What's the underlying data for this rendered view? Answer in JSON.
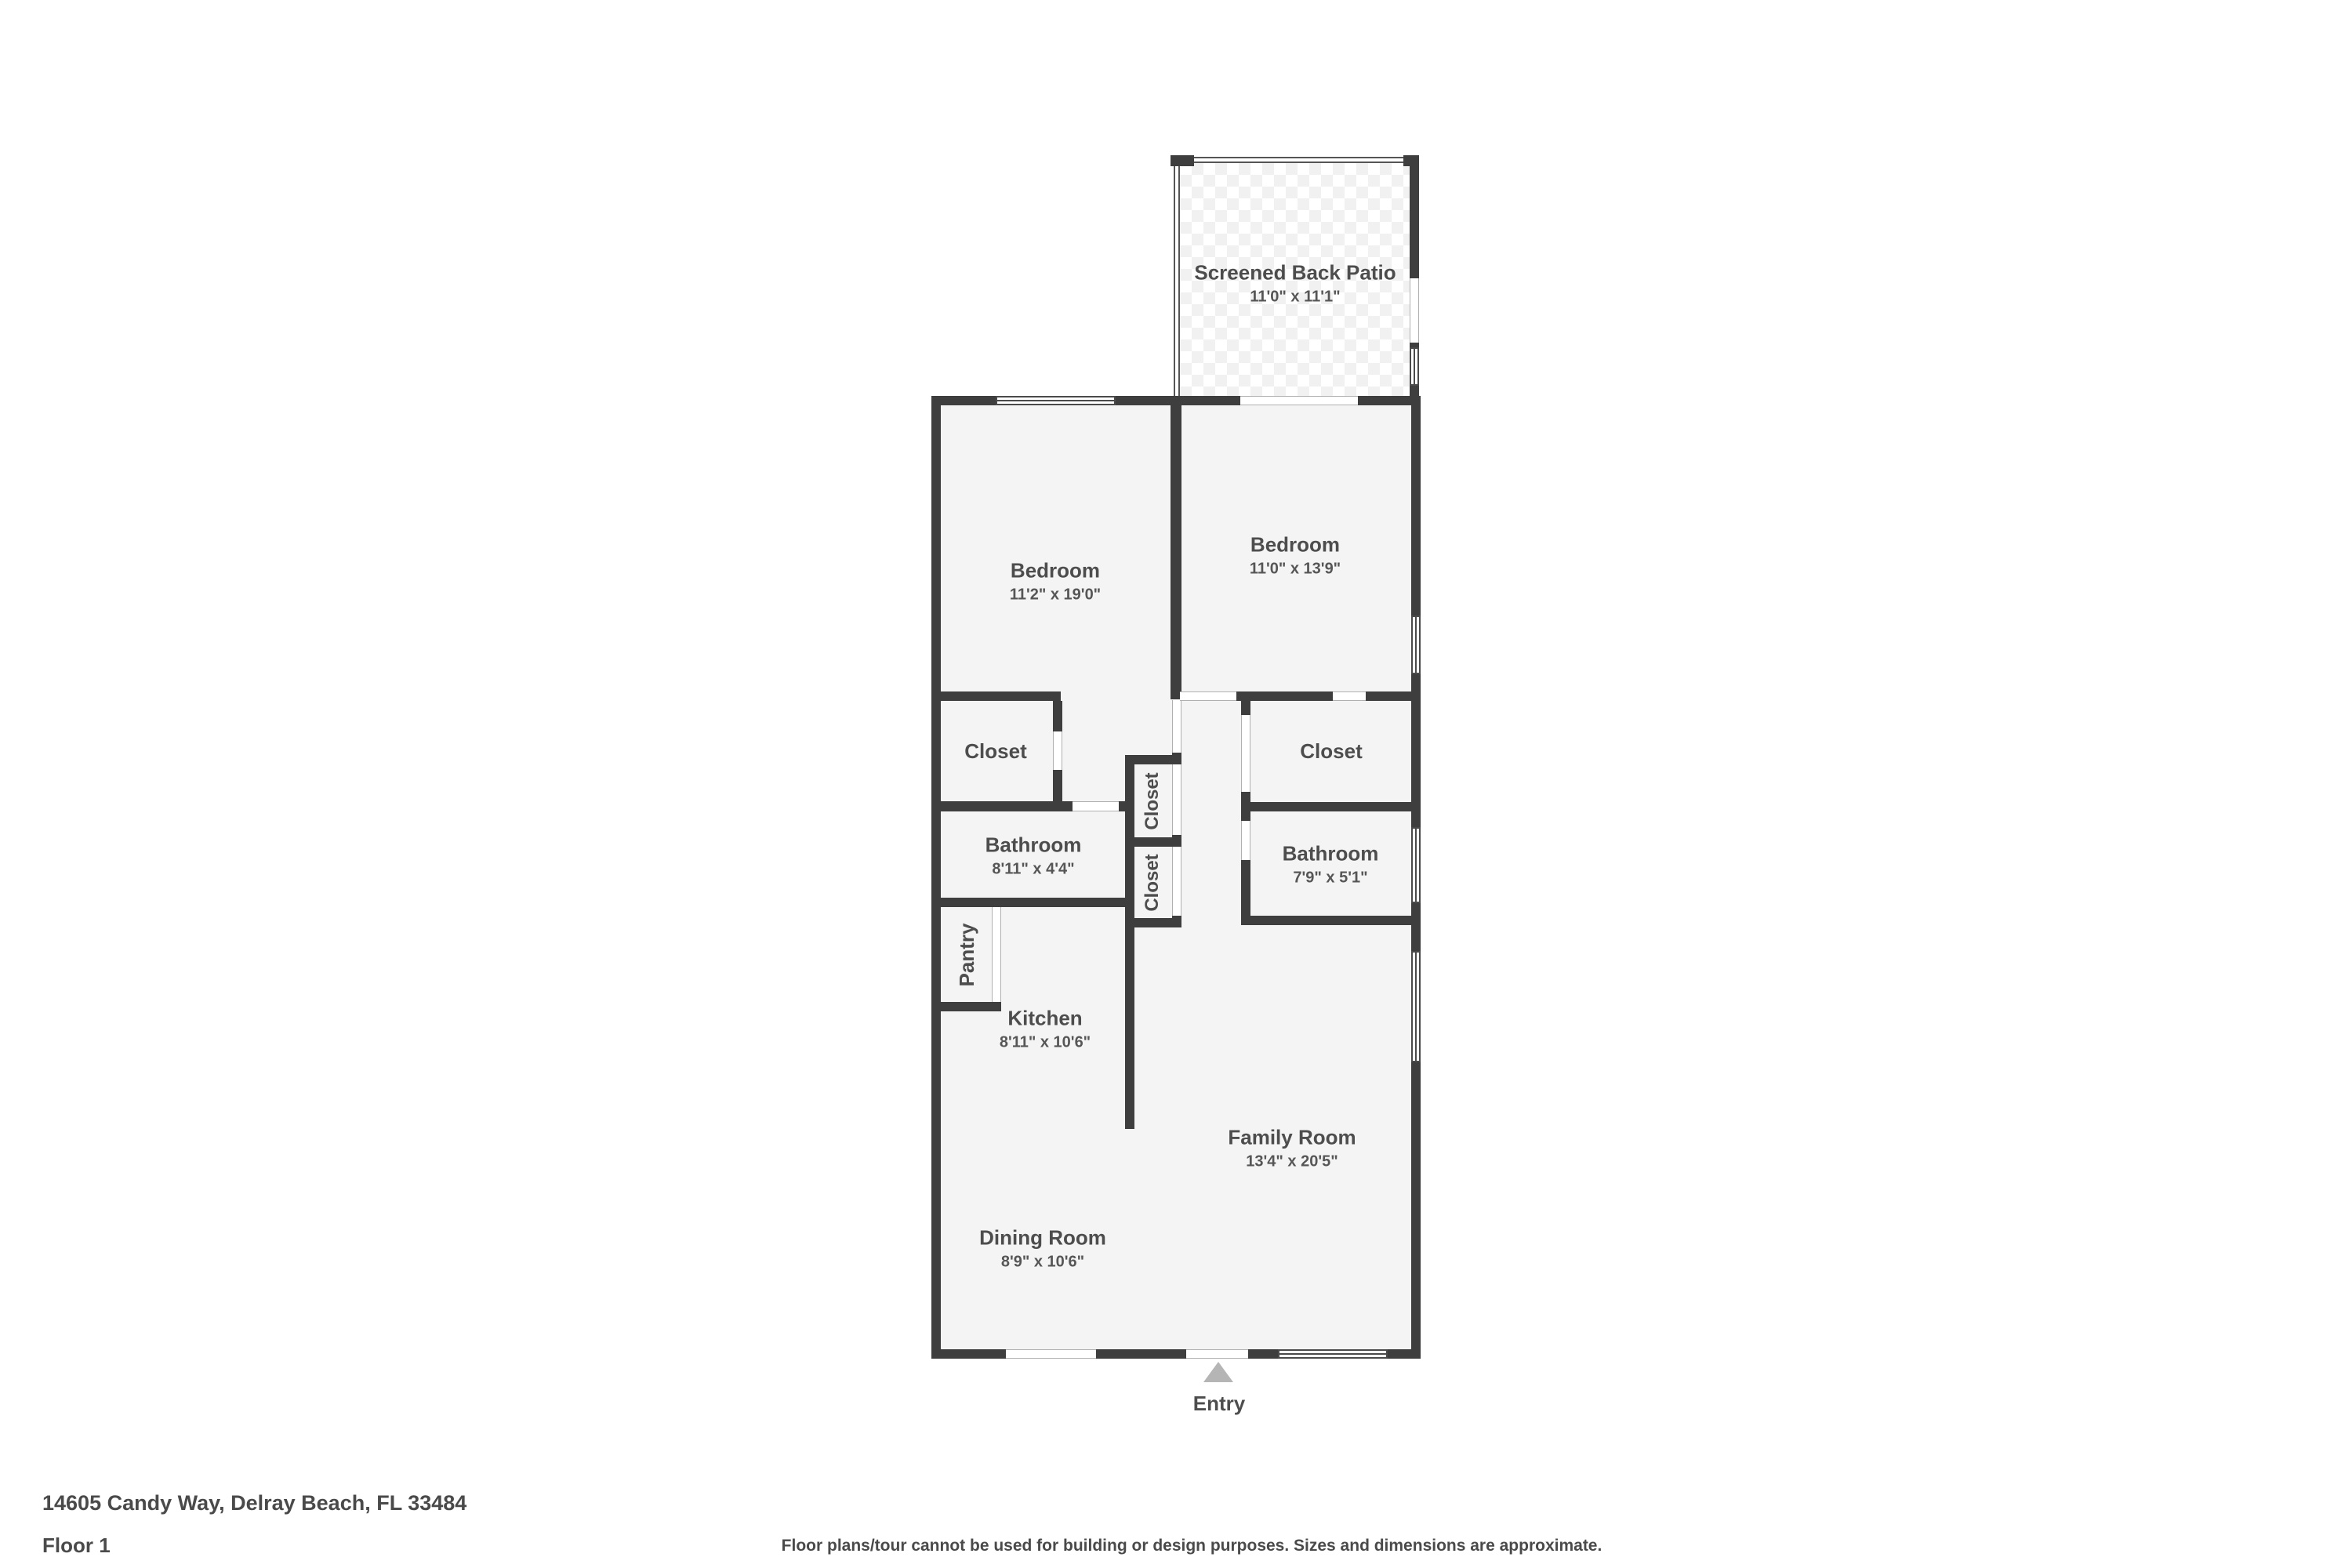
{
  "plan": {
    "rooms": [
      {
        "id": "screened-back-patio",
        "name": "Screened Back Patio",
        "dims": "11'0\" x 11'1\""
      },
      {
        "id": "bedroom-left",
        "name": "Bedroom",
        "dims": "11'2\" x 19'0\""
      },
      {
        "id": "bedroom-right",
        "name": "Bedroom",
        "dims": "11'0\" x 13'9\""
      },
      {
        "id": "closet-left",
        "name": "Closet"
      },
      {
        "id": "closet-right",
        "name": "Closet"
      },
      {
        "id": "closet-hall-upper",
        "name": "Closet"
      },
      {
        "id": "closet-hall-lower",
        "name": "Closet"
      },
      {
        "id": "bathroom-left",
        "name": "Bathroom",
        "dims": "8'11\" x 4'4\""
      },
      {
        "id": "bathroom-right",
        "name": "Bathroom",
        "dims": "7'9\" x 5'1\""
      },
      {
        "id": "pantry",
        "name": "Pantry"
      },
      {
        "id": "kitchen",
        "name": "Kitchen",
        "dims": "8'11\" x 10'6\""
      },
      {
        "id": "family-room",
        "name": "Family Room",
        "dims": "13'4\" x 20'5\""
      },
      {
        "id": "dining-room",
        "name": "Dining Room",
        "dims": "8'9\" x 10'6\""
      }
    ],
    "entry": {
      "label": "Entry"
    }
  },
  "footer": {
    "address": "14605 Candy Way, Delray Beach, FL 33484",
    "floor_label": "Floor 1",
    "disclaimer": "Floor plans/tour cannot be used for building or design purposes. Sizes and dimensions are approximate."
  },
  "colors": {
    "wall": "#3e3e3e",
    "floor": "#f4f4f4",
    "door_line": "#b0b0b0",
    "window_frame": "#4a4a4a",
    "screen_line": "#555555",
    "entry_arrow": "#b5b5b5",
    "text": "#4d4d4d",
    "tile_line": "#dedede"
  }
}
